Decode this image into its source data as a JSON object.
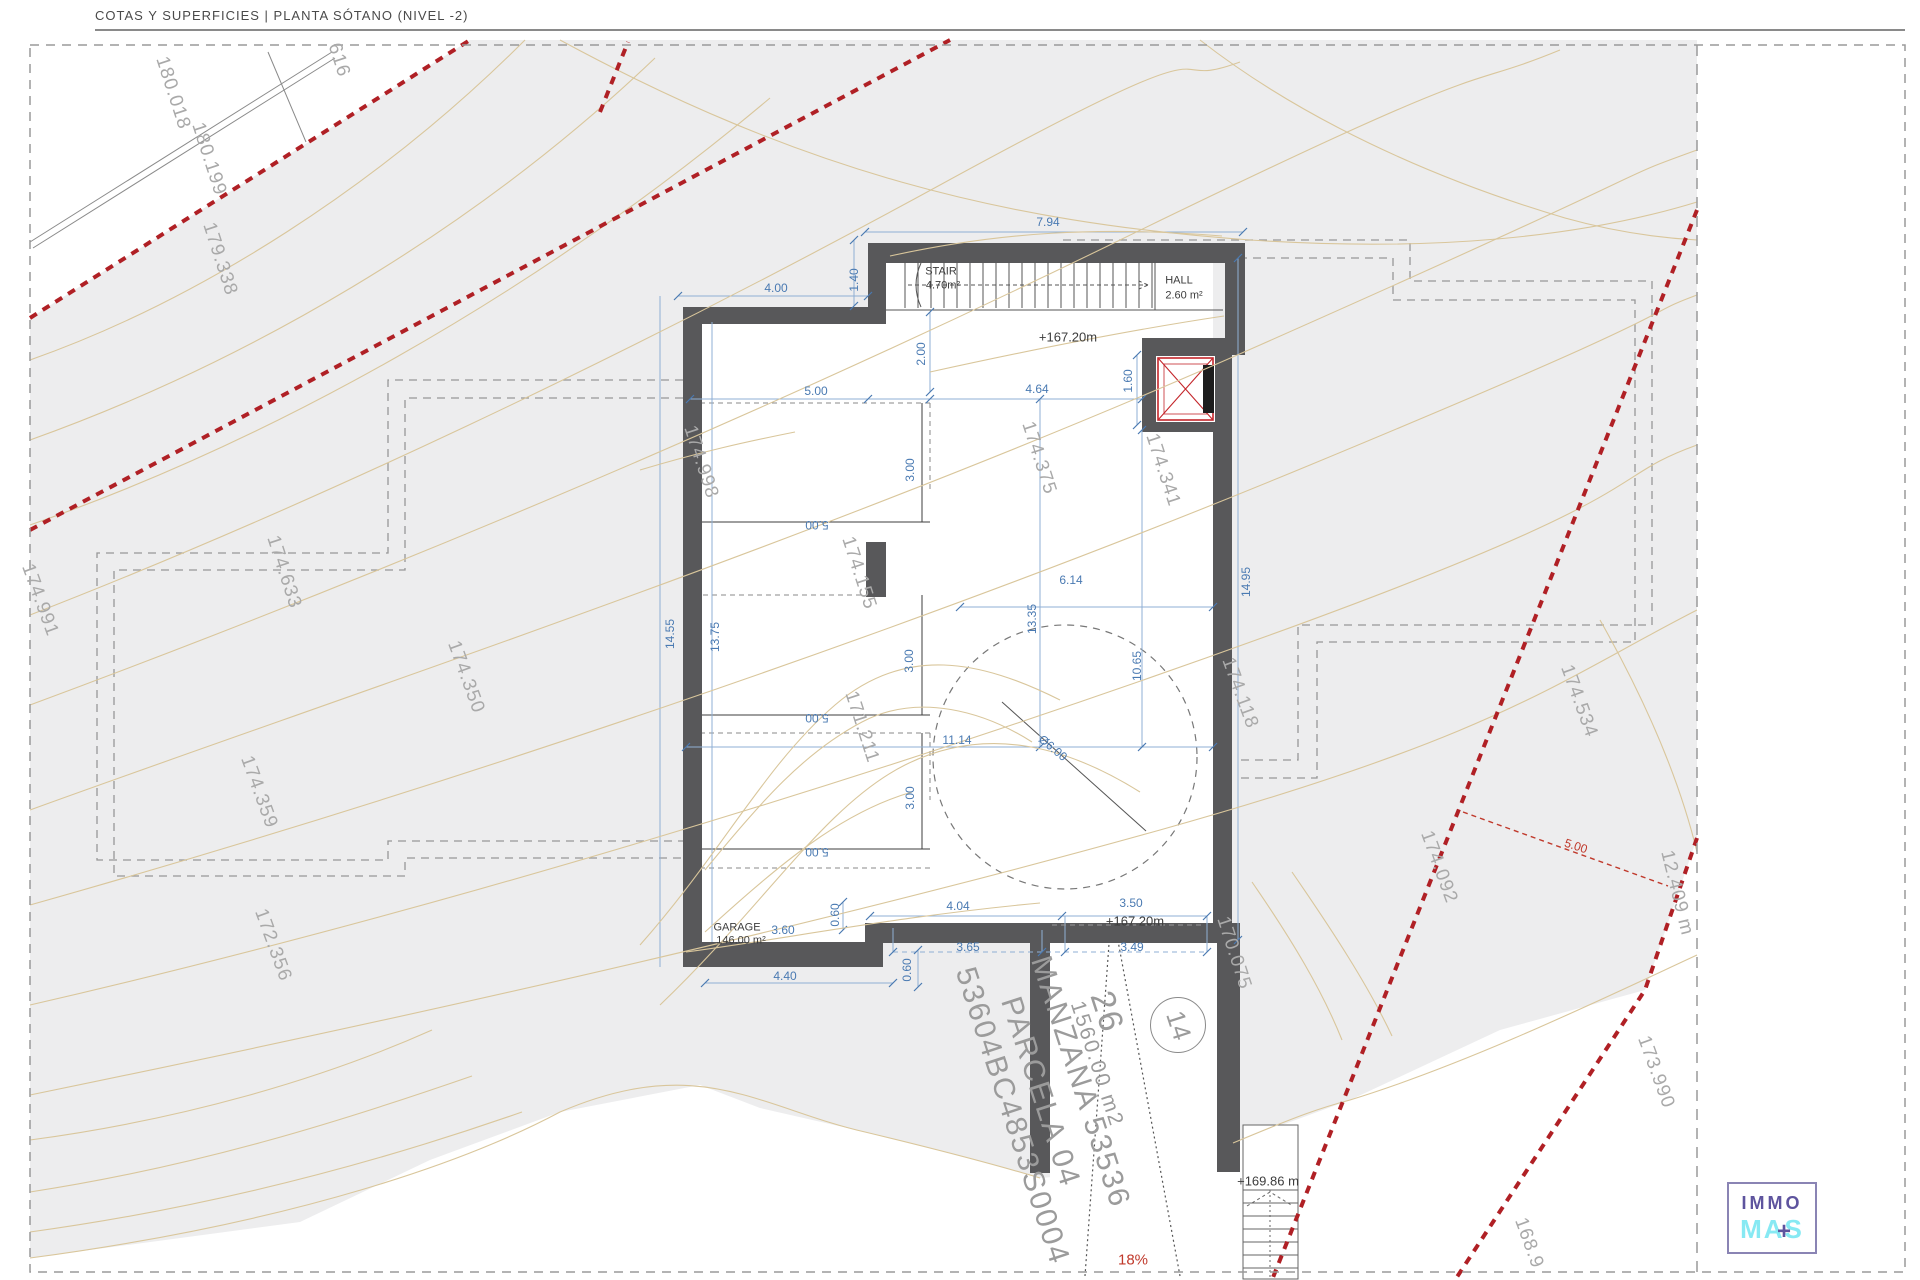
{
  "header": {
    "title": "COTAS Y SUPERFICIES | PLANTA SÓTANO (NIVEL -2)"
  },
  "logo": {
    "immo": "IMMO",
    "mas": "MAS",
    "plus": "+"
  },
  "colors": {
    "terrain": "#ededee",
    "walls": "#58585a",
    "contour_line": "#d9c69b",
    "boundary_red": "#b02025",
    "dimension_blue": "#4a7ab2",
    "contour_label": "#a9a9a9",
    "setback_dash": "#979797",
    "logo_purple": "#5e549e",
    "logo_cyan": "#87e9f3"
  },
  "rooms_info": [
    {
      "name": "STAIR",
      "area": "4.70m²"
    },
    {
      "name": "HALL",
      "area": "2.60 m²"
    },
    {
      "name": "GARAGE",
      "area": "146.00 m²"
    }
  ],
  "labels": {
    "dims": [
      {
        "t": "7.94",
        "x": 1048,
        "y": 222,
        "r": 0
      },
      {
        "t": "4.00",
        "x": 776,
        "y": 288,
        "r": 0
      },
      {
        "t": "1.40",
        "x": 854,
        "y": 280,
        "r": -90
      },
      {
        "t": "2.00",
        "x": 921,
        "y": 354,
        "r": -90
      },
      {
        "t": "5.00",
        "x": 816,
        "y": 391,
        "r": 0
      },
      {
        "t": "4.64",
        "x": 1037,
        "y": 389,
        "r": 0
      },
      {
        "t": "1.60",
        "x": 1128,
        "y": 381,
        "r": -90
      },
      {
        "t": "3.00",
        "x": 910,
        "y": 470,
        "r": -90
      },
      {
        "t": "5.00",
        "x": 817,
        "y": 525,
        "r": 180
      },
      {
        "t": "13.35",
        "x": 1032,
        "y": 619,
        "r": -90
      },
      {
        "t": "10.65",
        "x": 1137,
        "y": 666,
        "r": -90
      },
      {
        "t": "6.14",
        "x": 1071,
        "y": 580,
        "r": 0
      },
      {
        "t": "14.95",
        "x": 1246,
        "y": 582,
        "r": -90
      },
      {
        "t": "14.55",
        "x": 670,
        "y": 634,
        "r": -90
      },
      {
        "t": "13.75",
        "x": 715,
        "y": 637,
        "r": -90
      },
      {
        "t": "3.00",
        "x": 909,
        "y": 661,
        "r": -90
      },
      {
        "t": "5.00",
        "x": 817,
        "y": 718,
        "r": 180
      },
      {
        "t": "11.14",
        "x": 957,
        "y": 740,
        "r": 0
      },
      {
        "t": "3.00",
        "x": 910,
        "y": 798,
        "r": -90
      },
      {
        "t": "5.00",
        "x": 817,
        "y": 852,
        "r": 180
      },
      {
        "t": "Ø6.00",
        "x": 1053,
        "y": 748,
        "r": 40
      },
      {
        "t": "4.04",
        "x": 958,
        "y": 906,
        "r": 0
      },
      {
        "t": "3.50",
        "x": 1131,
        "y": 903,
        "r": 0
      },
      {
        "t": "3.60",
        "x": 783,
        "y": 930,
        "r": 0
      },
      {
        "t": "0.60",
        "x": 835,
        "y": 915,
        "r": -90
      },
      {
        "t": "3.65",
        "x": 968,
        "y": 947,
        "r": 0
      },
      {
        "t": "3.49",
        "x": 1132,
        "y": 947,
        "r": 0
      },
      {
        "t": "0.60",
        "x": 907,
        "y": 970,
        "r": -90
      },
      {
        "t": "4.40",
        "x": 785,
        "y": 976,
        "r": 0
      }
    ],
    "levels": [
      {
        "t": "+167.20m",
        "x": 1068,
        "y": 337,
        "r": 0
      },
      {
        "t": "+167.20m",
        "x": 1135,
        "y": 921,
        "r": 0
      },
      {
        "t": "+169.86 m",
        "x": 1268,
        "y": 1181,
        "r": 0
      }
    ],
    "rooms": [
      {
        "t": "STAIR",
        "x": 941,
        "y": 272,
        "r": 0
      },
      {
        "t": "4.70m²",
        "x": 943,
        "y": 286,
        "r": 0
      },
      {
        "t": "HALL",
        "x": 1179,
        "y": 281,
        "r": 0
      },
      {
        "t": "2.60 m²",
        "x": 1184,
        "y": 296,
        "r": 0
      },
      {
        "t": "GARAGE",
        "x": 737,
        "y": 928,
        "r": 0
      },
      {
        "t": "146.00 m²",
        "x": 741,
        "y": 941,
        "r": 0
      }
    ],
    "contours": [
      {
        "t": "616",
        "x": 339,
        "y": 60,
        "r": 72
      },
      {
        "t": "180.018",
        "x": 173,
        "y": 93,
        "r": 72
      },
      {
        "t": "180.199",
        "x": 209,
        "y": 159,
        "r": 72
      },
      {
        "t": "179.338",
        "x": 220,
        "y": 259,
        "r": 72
      },
      {
        "t": "174.633",
        "x": 284,
        "y": 572,
        "r": 72
      },
      {
        "t": "174.350",
        "x": 466,
        "y": 677,
        "r": 70
      },
      {
        "t": "174.991",
        "x": 40,
        "y": 600,
        "r": 70
      },
      {
        "t": "174.359",
        "x": 259,
        "y": 792,
        "r": 70
      },
      {
        "t": "172.356",
        "x": 273,
        "y": 945,
        "r": 70
      },
      {
        "t": "174.998",
        "x": 701,
        "y": 462,
        "r": 72
      },
      {
        "t": "174.155",
        "x": 859,
        "y": 573,
        "r": 72
      },
      {
        "t": "171.211",
        "x": 862,
        "y": 727,
        "r": 72
      },
      {
        "t": "174.375",
        "x": 1039,
        "y": 458,
        "r": 72
      },
      {
        "t": "174.341",
        "x": 1163,
        "y": 470,
        "r": 72
      },
      {
        "t": "174.118",
        "x": 1240,
        "y": 693,
        "r": 70
      },
      {
        "t": "170.075",
        "x": 1234,
        "y": 953,
        "r": 72
      },
      {
        "t": "174.534",
        "x": 1579,
        "y": 701,
        "r": 70
      },
      {
        "t": "174.092",
        "x": 1439,
        "y": 867,
        "r": 70
      },
      {
        "t": "173.990",
        "x": 1656,
        "y": 1072,
        "r": 70
      },
      {
        "t": "168.9",
        "x": 1529,
        "y": 1243,
        "r": 70
      },
      {
        "t": "12.409 m",
        "x": 1677,
        "y": 893,
        "r": 76
      }
    ],
    "parcel": [
      {
        "t": "MANZANA 53536",
        "x": 1080,
        "y": 1082,
        "r": 72,
        "s": 30
      },
      {
        "t": "PARCELA 04",
        "x": 1040,
        "y": 1092,
        "r": 72,
        "s": 30
      },
      {
        "t": "26",
        "x": 1107,
        "y": 1012,
        "r": 72,
        "s": 34
      },
      {
        "t": "1560.00 m2",
        "x": 1097,
        "y": 1064,
        "r": 72,
        "s": 21
      },
      {
        "t": "53604BC4853S0004",
        "x": 1012,
        "y": 1116,
        "r": 72,
        "s": 30
      }
    ],
    "reds": [
      {
        "t": "5.00",
        "x": 1576,
        "y": 846,
        "r": 18,
        "s": 12
      },
      {
        "t": "18%",
        "x": 1133,
        "y": 1260,
        "r": 0,
        "s": 15
      }
    ],
    "circled_number": "14"
  }
}
